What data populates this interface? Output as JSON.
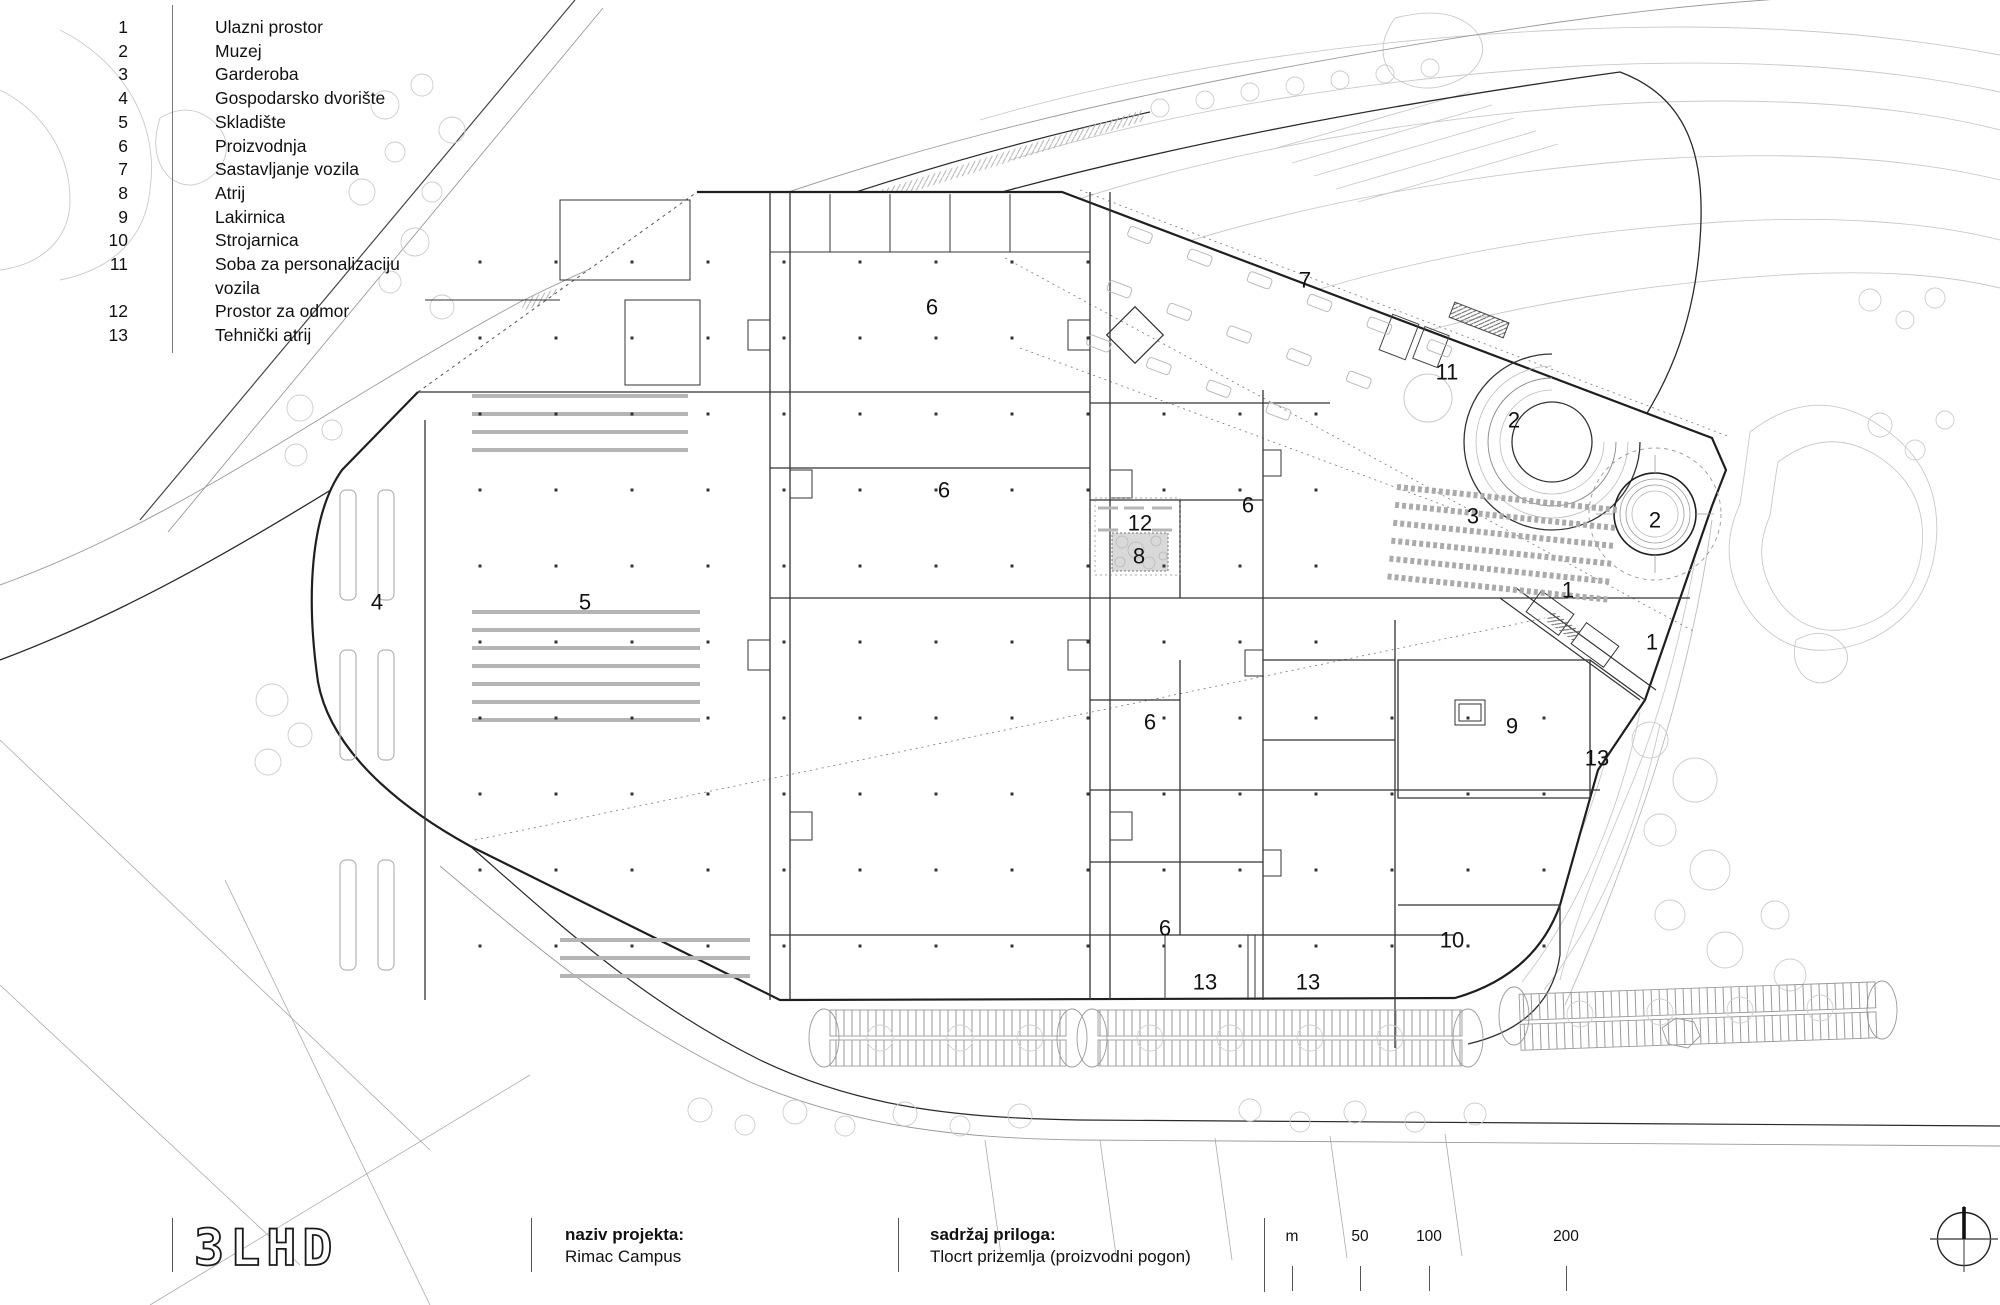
{
  "colors": {
    "ink": "#1f1f1f",
    "mid": "#555555",
    "light": "#aaaaaa",
    "xlight": "#c9c9c9",
    "fill_gray": "#d9d9d9"
  },
  "legend": {
    "items": [
      {
        "num": "1",
        "label": "Ulazni prostor"
      },
      {
        "num": "2",
        "label": "Muzej"
      },
      {
        "num": "3",
        "label": "Garderoba"
      },
      {
        "num": "4",
        "label": "Gospodarsko dvorište"
      },
      {
        "num": "5",
        "label": "Skladište"
      },
      {
        "num": "6",
        "label": "Proizvodnja"
      },
      {
        "num": "7",
        "label": "Sastavljanje vozila"
      },
      {
        "num": "8",
        "label": "Atrij"
      },
      {
        "num": "9",
        "label": "Lakirnica"
      },
      {
        "num": "10",
        "label": "Strojarnica"
      },
      {
        "num": "11",
        "label": "Soba za personalizaciju vozila"
      },
      {
        "num": "12",
        "label": "Prostor za odmor"
      },
      {
        "num": "13",
        "label": "Tehnički atrij"
      }
    ]
  },
  "plan": {
    "room_labels": [
      {
        "n": "7",
        "x": 1305,
        "y": 280
      },
      {
        "n": "6",
        "x": 932,
        "y": 307
      },
      {
        "n": "11",
        "x": 1447,
        "y": 372
      },
      {
        "n": "2",
        "x": 1514,
        "y": 420
      },
      {
        "n": "6",
        "x": 944,
        "y": 490
      },
      {
        "n": "6",
        "x": 1248,
        "y": 505
      },
      {
        "n": "12",
        "x": 1140,
        "y": 523
      },
      {
        "n": "3",
        "x": 1473,
        "y": 516
      },
      {
        "n": "2",
        "x": 1655,
        "y": 520
      },
      {
        "n": "8",
        "x": 1139,
        "y": 556
      },
      {
        "n": "1",
        "x": 1568,
        "y": 590
      },
      {
        "n": "1",
        "x": 1652,
        "y": 642
      },
      {
        "n": "4",
        "x": 377,
        "y": 602
      },
      {
        "n": "5",
        "x": 585,
        "y": 602
      },
      {
        "n": "6",
        "x": 1150,
        "y": 722
      },
      {
        "n": "9",
        "x": 1512,
        "y": 726
      },
      {
        "n": "13",
        "x": 1597,
        "y": 758
      },
      {
        "n": "6",
        "x": 1165,
        "y": 928
      },
      {
        "n": "10",
        "x": 1452,
        "y": 940
      },
      {
        "n": "13",
        "x": 1205,
        "y": 982
      },
      {
        "n": "13",
        "x": 1308,
        "y": 982
      }
    ]
  },
  "titleblock": {
    "logo": "3LHD",
    "project_label": "naziv projekta:",
    "project_value": "Rimac Campus",
    "content_label": "sadržaj priloga:",
    "content_value": "Tlocrt prizemlja (proizvodni pogon)",
    "scale_unit": "m",
    "scale_marks": [
      "50",
      "100",
      "200"
    ]
  }
}
